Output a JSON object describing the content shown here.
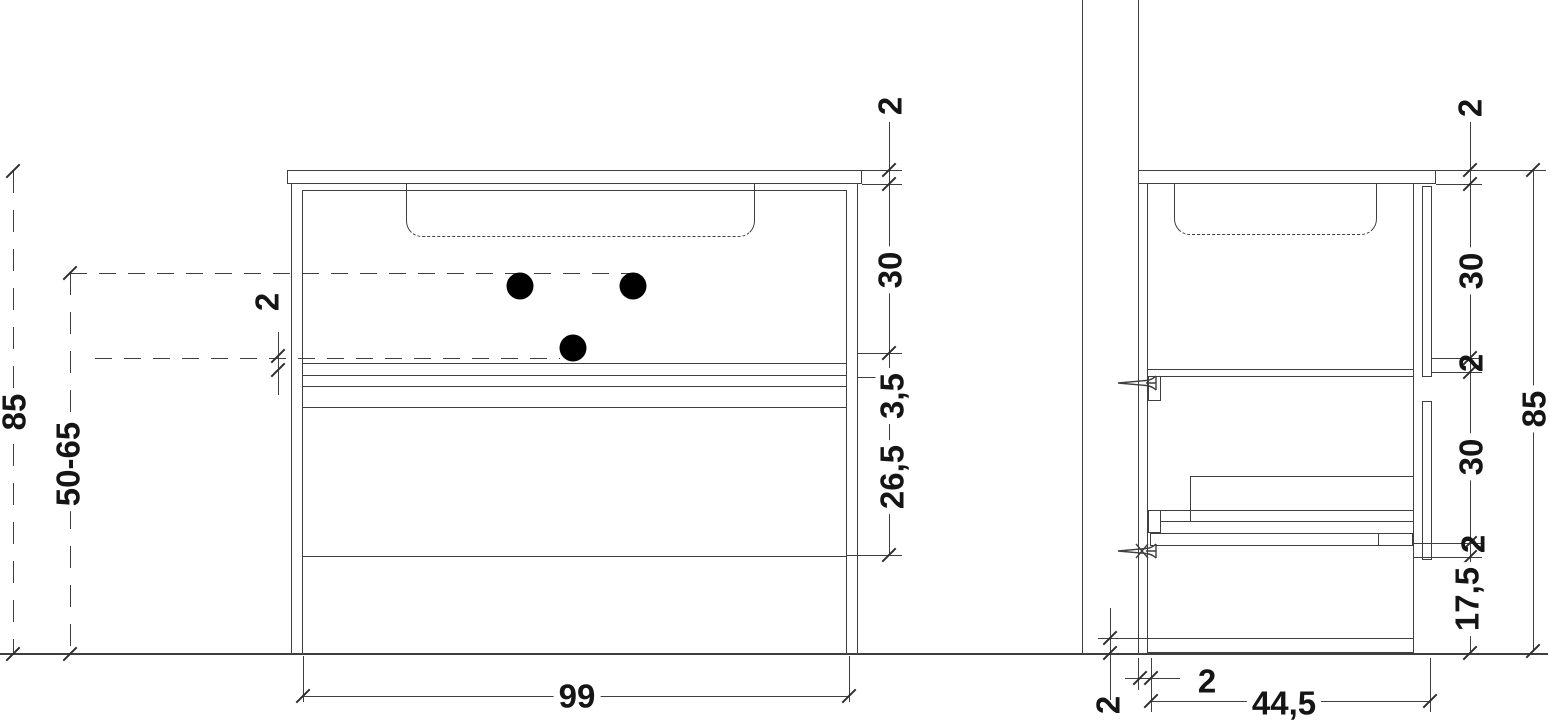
{
  "drawing": {
    "type": "furniture-technical-drawing",
    "background": "#ffffff",
    "line_color": "#3f3f3f",
    "text_color": "#151515",
    "units": "cm"
  },
  "labels": {
    "front": {
      "worktop_thickness": "2",
      "drawer1_height": "30",
      "gap_height": "3,5",
      "drawer2_height": "26,5",
      "width": "99",
      "total_height": "85",
      "drain_height_range": "50-65",
      "shelf_thickness": "2"
    },
    "side": {
      "worktop_thickness": "2",
      "upper_front_height": "30",
      "shelf_thickness": "2",
      "lower_front_height": "30",
      "stretcher_thickness": "2",
      "plinth_height": "17,5",
      "total_height": "85",
      "wall_gap": "2",
      "depth": "44,5",
      "bottom_panel_thickness": "2"
    }
  }
}
